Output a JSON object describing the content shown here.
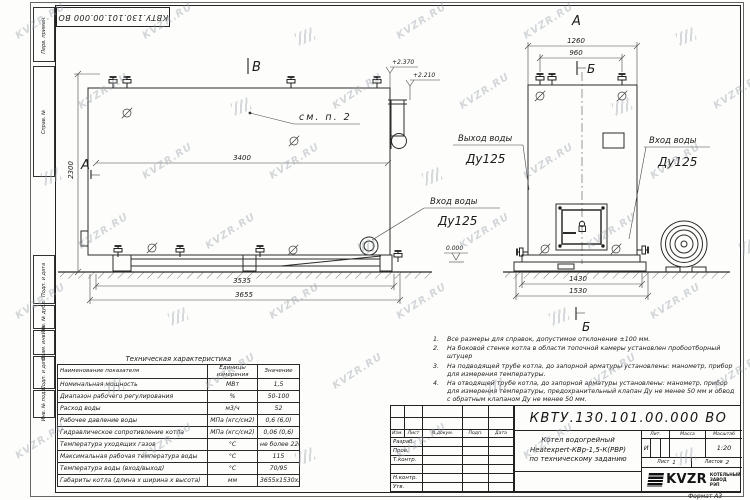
{
  "sheet": {
    "top_stamp": "КВТУ.130.101.00.000 ВО",
    "watermark": "KVZR.RU",
    "format_label": "Формат А3"
  },
  "margin_labels": [
    "Перв. примен.",
    "Справ. №",
    "Подп. и дата",
    "Инв. № дубл.",
    "Взам. инв. №",
    "Подп. и дата",
    "Инв. № подл."
  ],
  "left_view": {
    "section_b_label": "В",
    "section_a_label": "А",
    "see_note": "см. п. 2",
    "elevation_top": "+2.370",
    "elevation_mid": "+2.210",
    "elevation_zero": "0.000",
    "dim_width": "3400",
    "dim_height": "2300",
    "dim_base1": "3535",
    "dim_base2": "3655",
    "inlet_label_line1": "Вход воды",
    "inlet_label_line2": "Ду125"
  },
  "right_view": {
    "view_label": "А",
    "section_top_label": "Б",
    "section_bottom_label": "Б",
    "dim_top1": "1260",
    "dim_top2": "960",
    "dim_bottom1": "1430",
    "dim_bottom2": "1530",
    "outlet_label_line1": "Выход воды",
    "outlet_label_line2": "Ду125",
    "inlet_label_line1": "Вход воды",
    "inlet_label_line2": "Ду125"
  },
  "notes": {
    "items": [
      "Все размеры для справок, допустимое отклонение  ±100 мм.",
      "На боковой стенке котла в области топочной камеры установлен пробоотборный штуцер",
      "На подводящей трубе котла, до запорной арматуры установлены: манометр, прибор для измерения температуры.",
      "На отводящей трубе котла, до запорной арматуры установлены: манометр, прибор для измерения температуры, предохранительный клапан Ду не менее 50 мм и обвод с обратным клапаном Ду не менее 50 мм."
    ]
  },
  "tech_table": {
    "title": "Техническая характеристика",
    "headers": [
      "Наименование показателя",
      "Единицы измерения",
      "Значение"
    ],
    "rows": [
      [
        "Номинальная мощность",
        "МВт",
        "1,5"
      ],
      [
        "Диапазон рабочего регулирования",
        "%",
        "50-100"
      ],
      [
        "Расход воды",
        "м3/ч",
        "52"
      ],
      [
        "Рабочее давление воды",
        "МПа (кгс/см2)",
        "0,6 (6,0)"
      ],
      [
        "Гидравлическое сопротивление котла",
        "МПа (кгс/см2)",
        "0,06 (0,6)"
      ],
      [
        "Температура уходящих газов",
        "°С",
        "не более 220"
      ],
      [
        "Максимальная рабочая температура воды",
        "°С",
        "115"
      ],
      [
        "Температура воды (вход/выход)",
        "°С",
        "70/95"
      ],
      [
        "Габариты котла (длина х ширина х высота)",
        "мм",
        "3655х1530х2370"
      ]
    ]
  },
  "title_block": {
    "doc_number": "КВТУ.130.101.00.000 ВО",
    "header_cells": [
      "Изм.",
      "Лист",
      "N докум.",
      "Подп.",
      "Дата"
    ],
    "role_rows": [
      "Разраб.",
      "Пров.",
      "Т.контр.",
      "",
      "Н.контр.",
      "Утв."
    ],
    "name_line1": "Котел водогрейный",
    "name_line2": "Heatexpert-КВр-1,5-К(РВР)",
    "name_line3": "по техническому заданию",
    "lit_label": "Лит.",
    "mass_label": "Масса",
    "scale_label": "Масштаб",
    "lit_value": "И",
    "scale_value": "1:20",
    "sheet_label": "Лист",
    "sheet_value": "1",
    "sheets_label": "Листов",
    "sheets_value": "2",
    "company_logo": "KVZR",
    "company_name": "КОТЕЛЬНЫЙ ЗАВОД РЭП"
  }
}
